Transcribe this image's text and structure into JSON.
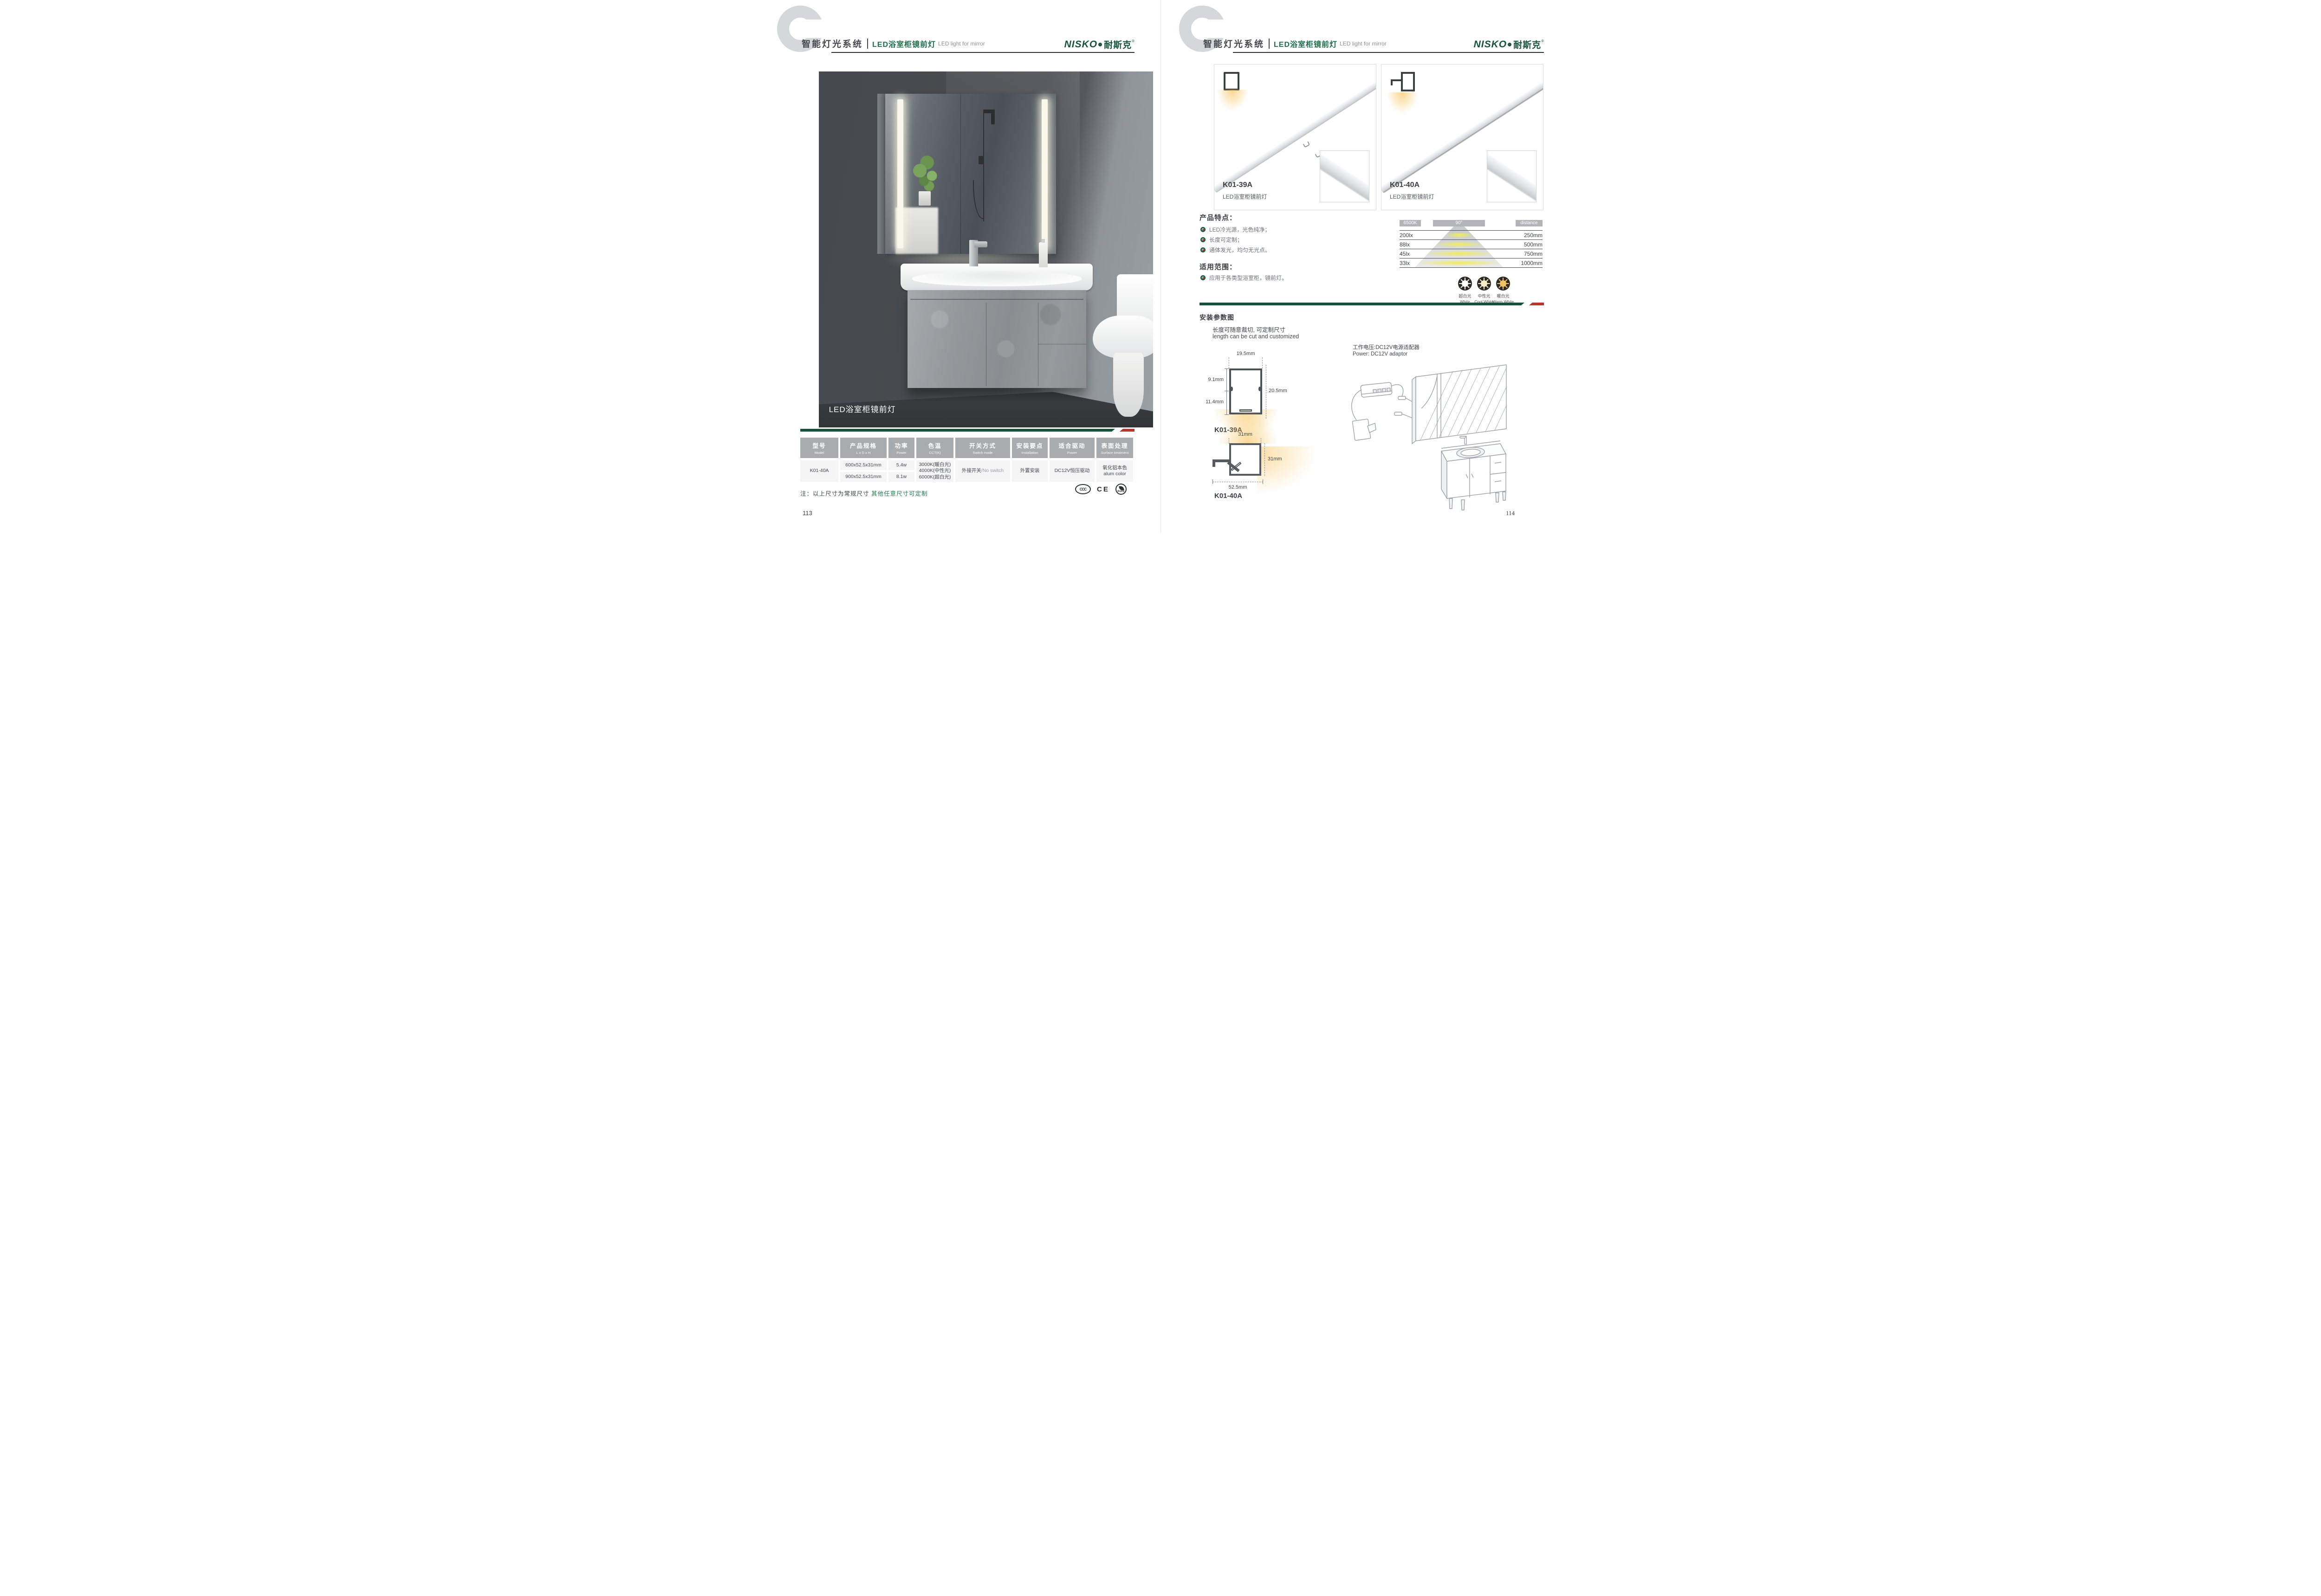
{
  "colors": {
    "brand_green": "#17543a",
    "title_green": "#1e6f4a",
    "divider_green": "#175238",
    "accent_red": "#b8342e",
    "table_header_gray": "#a9acae",
    "glow_orange": "#f6be4d",
    "cone_yellow": "#f4ed50"
  },
  "header": {
    "section": "智能灯光系统",
    "title_zh": "LED浴室柜镜前灯",
    "title_en": "LED light for mirror",
    "brand_en": "NISKO",
    "brand_zh": "耐斯克",
    "brand_reg": "®"
  },
  "left": {
    "photo_caption": "LED浴室柜镜前灯",
    "table": {
      "headers": [
        {
          "zh": "型号",
          "en": "Model"
        },
        {
          "zh": "产品规格",
          "en": "L x D x H"
        },
        {
          "zh": "功率",
          "en": "Power"
        },
        {
          "zh": "色温",
          "en": "CCT(K)"
        },
        {
          "zh": "开关方式",
          "en": "Switch mode"
        },
        {
          "zh": "安装要点",
          "en": "Installation"
        },
        {
          "zh": "适合驱动",
          "en": "Power"
        },
        {
          "zh": "表面处理",
          "en": "Surface treatment"
        }
      ],
      "model": "K01-40A",
      "size_1": "600x52.5x31mm",
      "size_2": "900x52.5x31mm",
      "power_1": "5.4w",
      "power_2": "8.1w",
      "cct_1": "3000K(暖白光)",
      "cct_2": "4000K(中性光)",
      "cct_3": "6000K(超白光)",
      "switch_zh": "外接开关",
      "switch_en": "/No switch",
      "installation": "外置安装",
      "driver": "DC12V恒压驱动",
      "surface_zh": "氧化铝本色",
      "surface_en": "alum color"
    },
    "note_prefix": "注：以上尺寸为常规尺寸 ",
    "note_highlight": "其他任意尺寸可定制",
    "certs": [
      "CCC",
      "CE",
      "RoHS"
    ],
    "page_number": "113"
  },
  "right": {
    "products": [
      {
        "model": "K01-39A",
        "name": "LED浴室柜镜前灯"
      },
      {
        "model": "K01-40A",
        "name": "LED浴室柜镜前灯"
      }
    ],
    "features_title": "产品特点：",
    "features": [
      "LED冷光源，光色纯净；",
      "长度可定制；",
      "通体发光，均匀无光点。"
    ],
    "application_title": "适用范围：",
    "application": "应用于各类型浴室柜，镜前灯。",
    "photometric": {
      "cct": "6500K",
      "angle": "90°",
      "distance_label": "distance",
      "rows": [
        {
          "lux": "200lx",
          "distance": "250mm"
        },
        {
          "lux": "88lx",
          "distance": "500mm"
        },
        {
          "lux": "45lx",
          "distance": "750mm"
        },
        {
          "lux": "33lx",
          "distance": "1000mm"
        }
      ]
    },
    "cct_icons": [
      {
        "zh": "超白光",
        "en": "White",
        "color": "#ffffff"
      },
      {
        "zh": "中性光",
        "en": "Cool White",
        "color": "#f6ecc7"
      },
      {
        "zh": "暖白光",
        "en": "Warm White",
        "color": "#f0c367"
      }
    ],
    "install_title": "安装参数图",
    "cut_note_zh": "长度可随意裁切, 可定制尺寸",
    "cut_note_en": "length can be cut and customized",
    "power_note_zh": "工作电压:DC12V电源适配器",
    "power_note_en": "Power: DC12V adaptor",
    "profile1": {
      "model": "K01-39A",
      "width": "19.5mm",
      "upper": "9.1mm",
      "lower": "11.4mm",
      "height": "20.5mm"
    },
    "profile2": {
      "model": "K01-40A",
      "top": "31mm",
      "side": "31mm",
      "bottom": "52.5mm"
    },
    "page_number": "114"
  }
}
